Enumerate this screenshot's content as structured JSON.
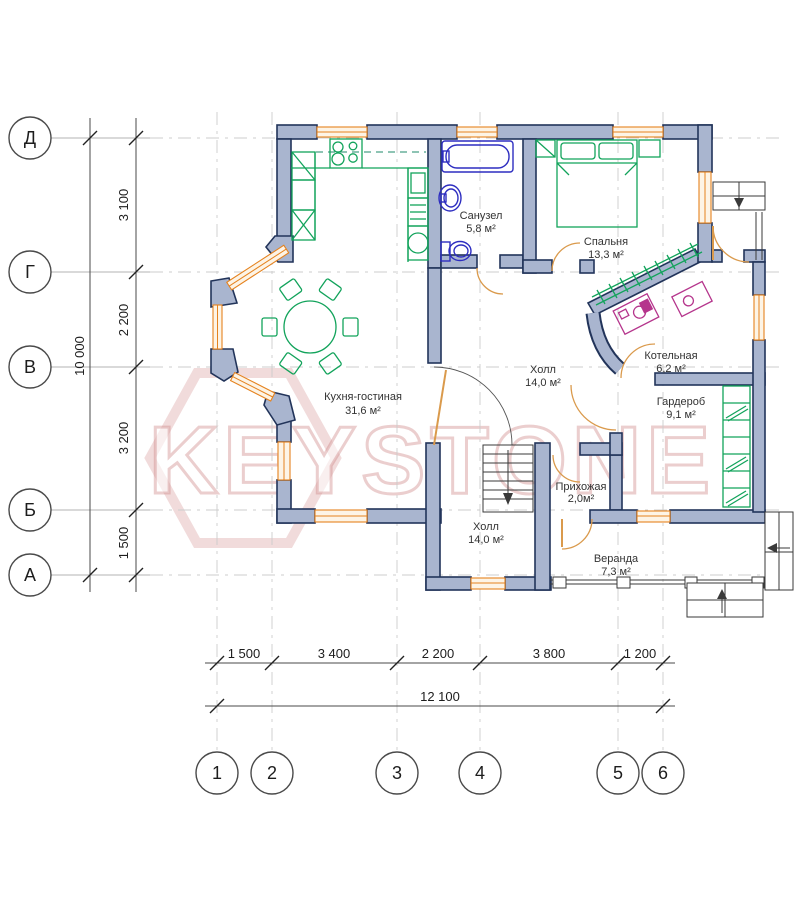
{
  "plan": {
    "rooms": [
      {
        "id": "sanuzel",
        "name": "Санузел",
        "area": "5,8 м²"
      },
      {
        "id": "spalnya",
        "name": "Спальня",
        "area": "13,3 м²"
      },
      {
        "id": "kuhnya",
        "name": "Кухня-гостиная",
        "area": "31,6 м²"
      },
      {
        "id": "holl_upper",
        "name": "Холл",
        "area": "14,0 м²"
      },
      {
        "id": "kotelnaya",
        "name": "Котельная",
        "area": "6,2 м²"
      },
      {
        "id": "garderob",
        "name": "Гардероб",
        "area": "9,1 м²"
      },
      {
        "id": "prihozhaya",
        "name": "Прихожая",
        "area": "2,0м²"
      },
      {
        "id": "holl_lower",
        "name": "Холл",
        "area": "14,0 м²"
      },
      {
        "id": "veranda",
        "name": "Веранда",
        "area": "7,3 м²"
      }
    ]
  },
  "axes": {
    "rows": [
      {
        "label": "Д"
      },
      {
        "label": "Г"
      },
      {
        "label": "В"
      },
      {
        "label": "Б"
      },
      {
        "label": "А"
      }
    ],
    "cols": [
      {
        "label": "1"
      },
      {
        "label": "2"
      },
      {
        "label": "3"
      },
      {
        "label": "4"
      },
      {
        "label": "5"
      },
      {
        "label": "6"
      }
    ]
  },
  "dimensions": {
    "vertical": {
      "segments": [
        "3 100",
        "2 200",
        "3 200",
        "1 500"
      ],
      "total": "10 000"
    },
    "horizontal": {
      "segments": [
        "1 500",
        "3 400",
        "2 200",
        "3 800",
        "1 200"
      ],
      "total": "12 100"
    }
  },
  "watermark": {
    "text": "KEYSTONE"
  },
  "colors": {
    "wall_fill": "#a9b5cf",
    "wall_stroke": "#22345a",
    "window": "#e5821e",
    "furniture": "#12a35b",
    "plumbing": "#2d2dc0",
    "equipment": "#b5358c",
    "dim_lines": "#4a4a4a",
    "grid": "#cccccc",
    "watermark": "#cb7f7f"
  }
}
